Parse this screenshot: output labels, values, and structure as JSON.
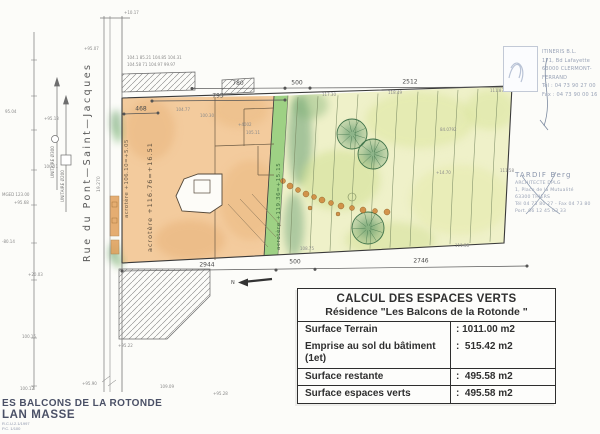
{
  "colors": {
    "paper": "#fcfcf9",
    "building_wash": "#f3cb9d",
    "garden_wash": "#eff1c9",
    "green_strip": "#9ed184",
    "tree_stroke": "#3f7249",
    "tree_fill": "#4e8f63",
    "ink": "#3a3a3a",
    "dim_gray": "#4a4a4a",
    "mark_gray": "#8a8a8a",
    "contour_green": "#76865f",
    "stamp_blue": "#99a3b6",
    "title_blue": "#4a5066",
    "orange_dot": "#d08a3e"
  },
  "table": {
    "title": "CALCUL DES ESPACES VERTS",
    "subtitle": "Résidence \"Les Balcons de la Rotonde \"",
    "groups": [
      [
        {
          "label": "Surface Terrain",
          "value": ": 1011.00 m2"
        },
        {
          "label": "Emprise au sol du bâtiment\n(1et)",
          "value": ":  515.42 m2"
        }
      ],
      [
        {
          "label": "Surface restante",
          "value": ":  495.58 m2"
        }
      ],
      [
        {
          "label": "Surface espaces verts",
          "value": ":  495.58 m2"
        }
      ]
    ]
  },
  "dims": {
    "top": [
      "780",
      "500",
      "2512"
    ],
    "mid": "795",
    "small": "468",
    "bottom": [
      "2944",
      "500",
      "2746"
    ]
  },
  "labels": {
    "street": "Rue   du   Pont—Saint—Jacques",
    "north": "N",
    "acrotere_a": "acrotère +106.10=+5.05",
    "acrotere_b": "acrotère +116.76=+16.51",
    "acrotere_c": "acrotère +119.36=+15.15",
    "note_road": "19.270",
    "utility_1": "UNITAIRE Ø300",
    "utility_2": "UNITAIRE Ø200"
  },
  "vendor": {
    "lines": [
      "ITINERIS B.L.",
      "171, Bd Lafayette",
      "63000 CLERMONT-FERRAND",
      "Tél : 04 73 90 27 00",
      "Fax : 04 73 90 00 16"
    ]
  },
  "stamp": {
    "lines": [
      "TARDIF Berg",
      "ARCHITECTE DPLG",
      "1, Place de la Mutualité",
      "63300 THIERS",
      "Tél 04 73 80 27 - Fax 04 73 80",
      "Port. 06 12 45 03 33"
    ]
  },
  "title_block": {
    "line1": "ES BALCONS DE LA ROTONDE",
    "line2": "LAN MASSE",
    "small1": "R.C.U.2.1/1997",
    "small2": "P.C. 1/100"
  },
  "plan": {
    "contours": {
      "count": 11,
      "x0": 298,
      "step": 20,
      "color": "#76865f"
    },
    "trees": [
      {
        "cx": 352,
        "cy": 134,
        "r": 15
      },
      {
        "cx": 373,
        "cy": 154,
        "r": 15
      },
      {
        "cx": 368,
        "cy": 228,
        "r": 16
      }
    ],
    "path_dots": [
      [
        283,
        181,
        2.5
      ],
      [
        290,
        186,
        3
      ],
      [
        298,
        190,
        2.5
      ],
      [
        306,
        194,
        3
      ],
      [
        314,
        197,
        2.5
      ],
      [
        322,
        200,
        3
      ],
      [
        331,
        203,
        2.5
      ],
      [
        341,
        206,
        3
      ],
      [
        352,
        208,
        2.5
      ],
      [
        363,
        210,
        3
      ],
      [
        375,
        211,
        2.5
      ],
      [
        387,
        212,
        3
      ],
      [
        338,
        214,
        2
      ],
      [
        310,
        208,
        2
      ]
    ],
    "blobs_garden": [
      {
        "x": 300,
        "y": 140,
        "rx": 12,
        "ry": 45,
        "c": "#4e8f63",
        "o": 0.45
      },
      {
        "x": 294,
        "y": 225,
        "rx": 10,
        "ry": 32,
        "c": "#4e8f63",
        "o": 0.4
      },
      {
        "x": 310,
        "y": 105,
        "rx": 18,
        "ry": 14,
        "c": "#6aa565",
        "o": 0.35
      },
      {
        "x": 340,
        "y": 180,
        "rx": 40,
        "ry": 30,
        "c": "#cede8e",
        "o": 0.5
      },
      {
        "x": 420,
        "y": 120,
        "rx": 55,
        "ry": 28,
        "c": "#dde6a0",
        "o": 0.55
      },
      {
        "x": 460,
        "y": 200,
        "rx": 50,
        "ry": 35,
        "c": "#e4e9a8",
        "o": 0.5
      },
      {
        "x": 390,
        "y": 240,
        "rx": 45,
        "ry": 18,
        "c": "#cfdd90",
        "o": 0.45
      },
      {
        "x": 490,
        "y": 110,
        "rx": 25,
        "ry": 20,
        "c": "#d8e49a",
        "o": 0.5
      }
    ],
    "blobs_building": [
      {
        "x": 150,
        "y": 130,
        "rx": 25,
        "ry": 30,
        "c": "#e8b47c",
        "o": 0.5
      },
      {
        "x": 250,
        "y": 200,
        "rx": 30,
        "ry": 40,
        "c": "#eab87f",
        "o": 0.5
      },
      {
        "x": 190,
        "y": 240,
        "rx": 35,
        "ry": 20,
        "c": "#e5ad72",
        "o": 0.45
      },
      {
        "x": 240,
        "y": 110,
        "rx": 28,
        "ry": 18,
        "c": "#e9b87e",
        "o": 0.45
      }
    ],
    "blobs_roadside": [
      {
        "x": 116,
        "y": 122,
        "rx": 5,
        "ry": 12,
        "c": "#5f9a5f",
        "o": 0.6
      },
      {
        "x": 118,
        "y": 135,
        "rx": 4,
        "ry": 8,
        "c": "#6faf67",
        "o": 0.6
      },
      {
        "x": 114,
        "y": 253,
        "rx": 5,
        "ry": 10,
        "c": "#5f9a5f",
        "o": 0.6
      },
      {
        "x": 119,
        "y": 262,
        "rx": 4,
        "ry": 6,
        "c": "#79b06a",
        "o": 0.6
      }
    ],
    "survey_marks": [
      {
        "t": "+10.17",
        "x": 124,
        "y": 14
      },
      {
        "t": "+95.07",
        "x": 84,
        "y": 50
      },
      {
        "t": "95.04",
        "x": 5,
        "y": 113
      },
      {
        "t": "+95.13",
        "x": 44,
        "y": 120
      },
      {
        "t": "100.21",
        "x": 44,
        "y": 168
      },
      {
        "t": "MGED 123.00",
        "x": 2,
        "y": 196
      },
      {
        "t": "+95.68",
        "x": 14,
        "y": 204
      },
      {
        "t": "-80.14",
        "x": 2,
        "y": 243
      },
      {
        "t": "+20.03",
        "x": 28,
        "y": 276
      },
      {
        "t": "100.15",
        "x": 22,
        "y": 338
      },
      {
        "t": "100.12",
        "x": 20,
        "y": 390
      },
      {
        "t": "+95.90",
        "x": 82,
        "y": 385
      },
      {
        "t": "109.09",
        "x": 160,
        "y": 388
      },
      {
        "t": "+95.28",
        "x": 213,
        "y": 395
      },
      {
        "t": "104.77",
        "x": 176,
        "y": 111
      },
      {
        "t": "100.30",
        "x": 200,
        "y": 117
      },
      {
        "t": "+4002",
        "x": 238,
        "y": 126
      },
      {
        "t": "105.11",
        "x": 246,
        "y": 134
      },
      {
        "t": "117.30",
        "x": 322,
        "y": 96
      },
      {
        "t": "118.49",
        "x": 388,
        "y": 94
      },
      {
        "t": "84.0792",
        "x": 440,
        "y": 131
      },
      {
        "t": "+14.70",
        "x": 436,
        "y": 174
      },
      {
        "t": "111.58",
        "x": 500,
        "y": 172
      },
      {
        "t": "111.87",
        "x": 490,
        "y": 92
      },
      {
        "t": "111.38",
        "x": 455,
        "y": 247
      },
      {
        "t": "108.75",
        "x": 300,
        "y": 250
      },
      {
        "t": "+95.22",
        "x": 118,
        "y": 347
      },
      {
        "t": "104.1 85.21 104.85 104.31",
        "x": 127,
        "y": 59
      },
      {
        "t": "104.58 71 104.97 99.97",
        "x": 127,
        "y": 66
      }
    ]
  }
}
